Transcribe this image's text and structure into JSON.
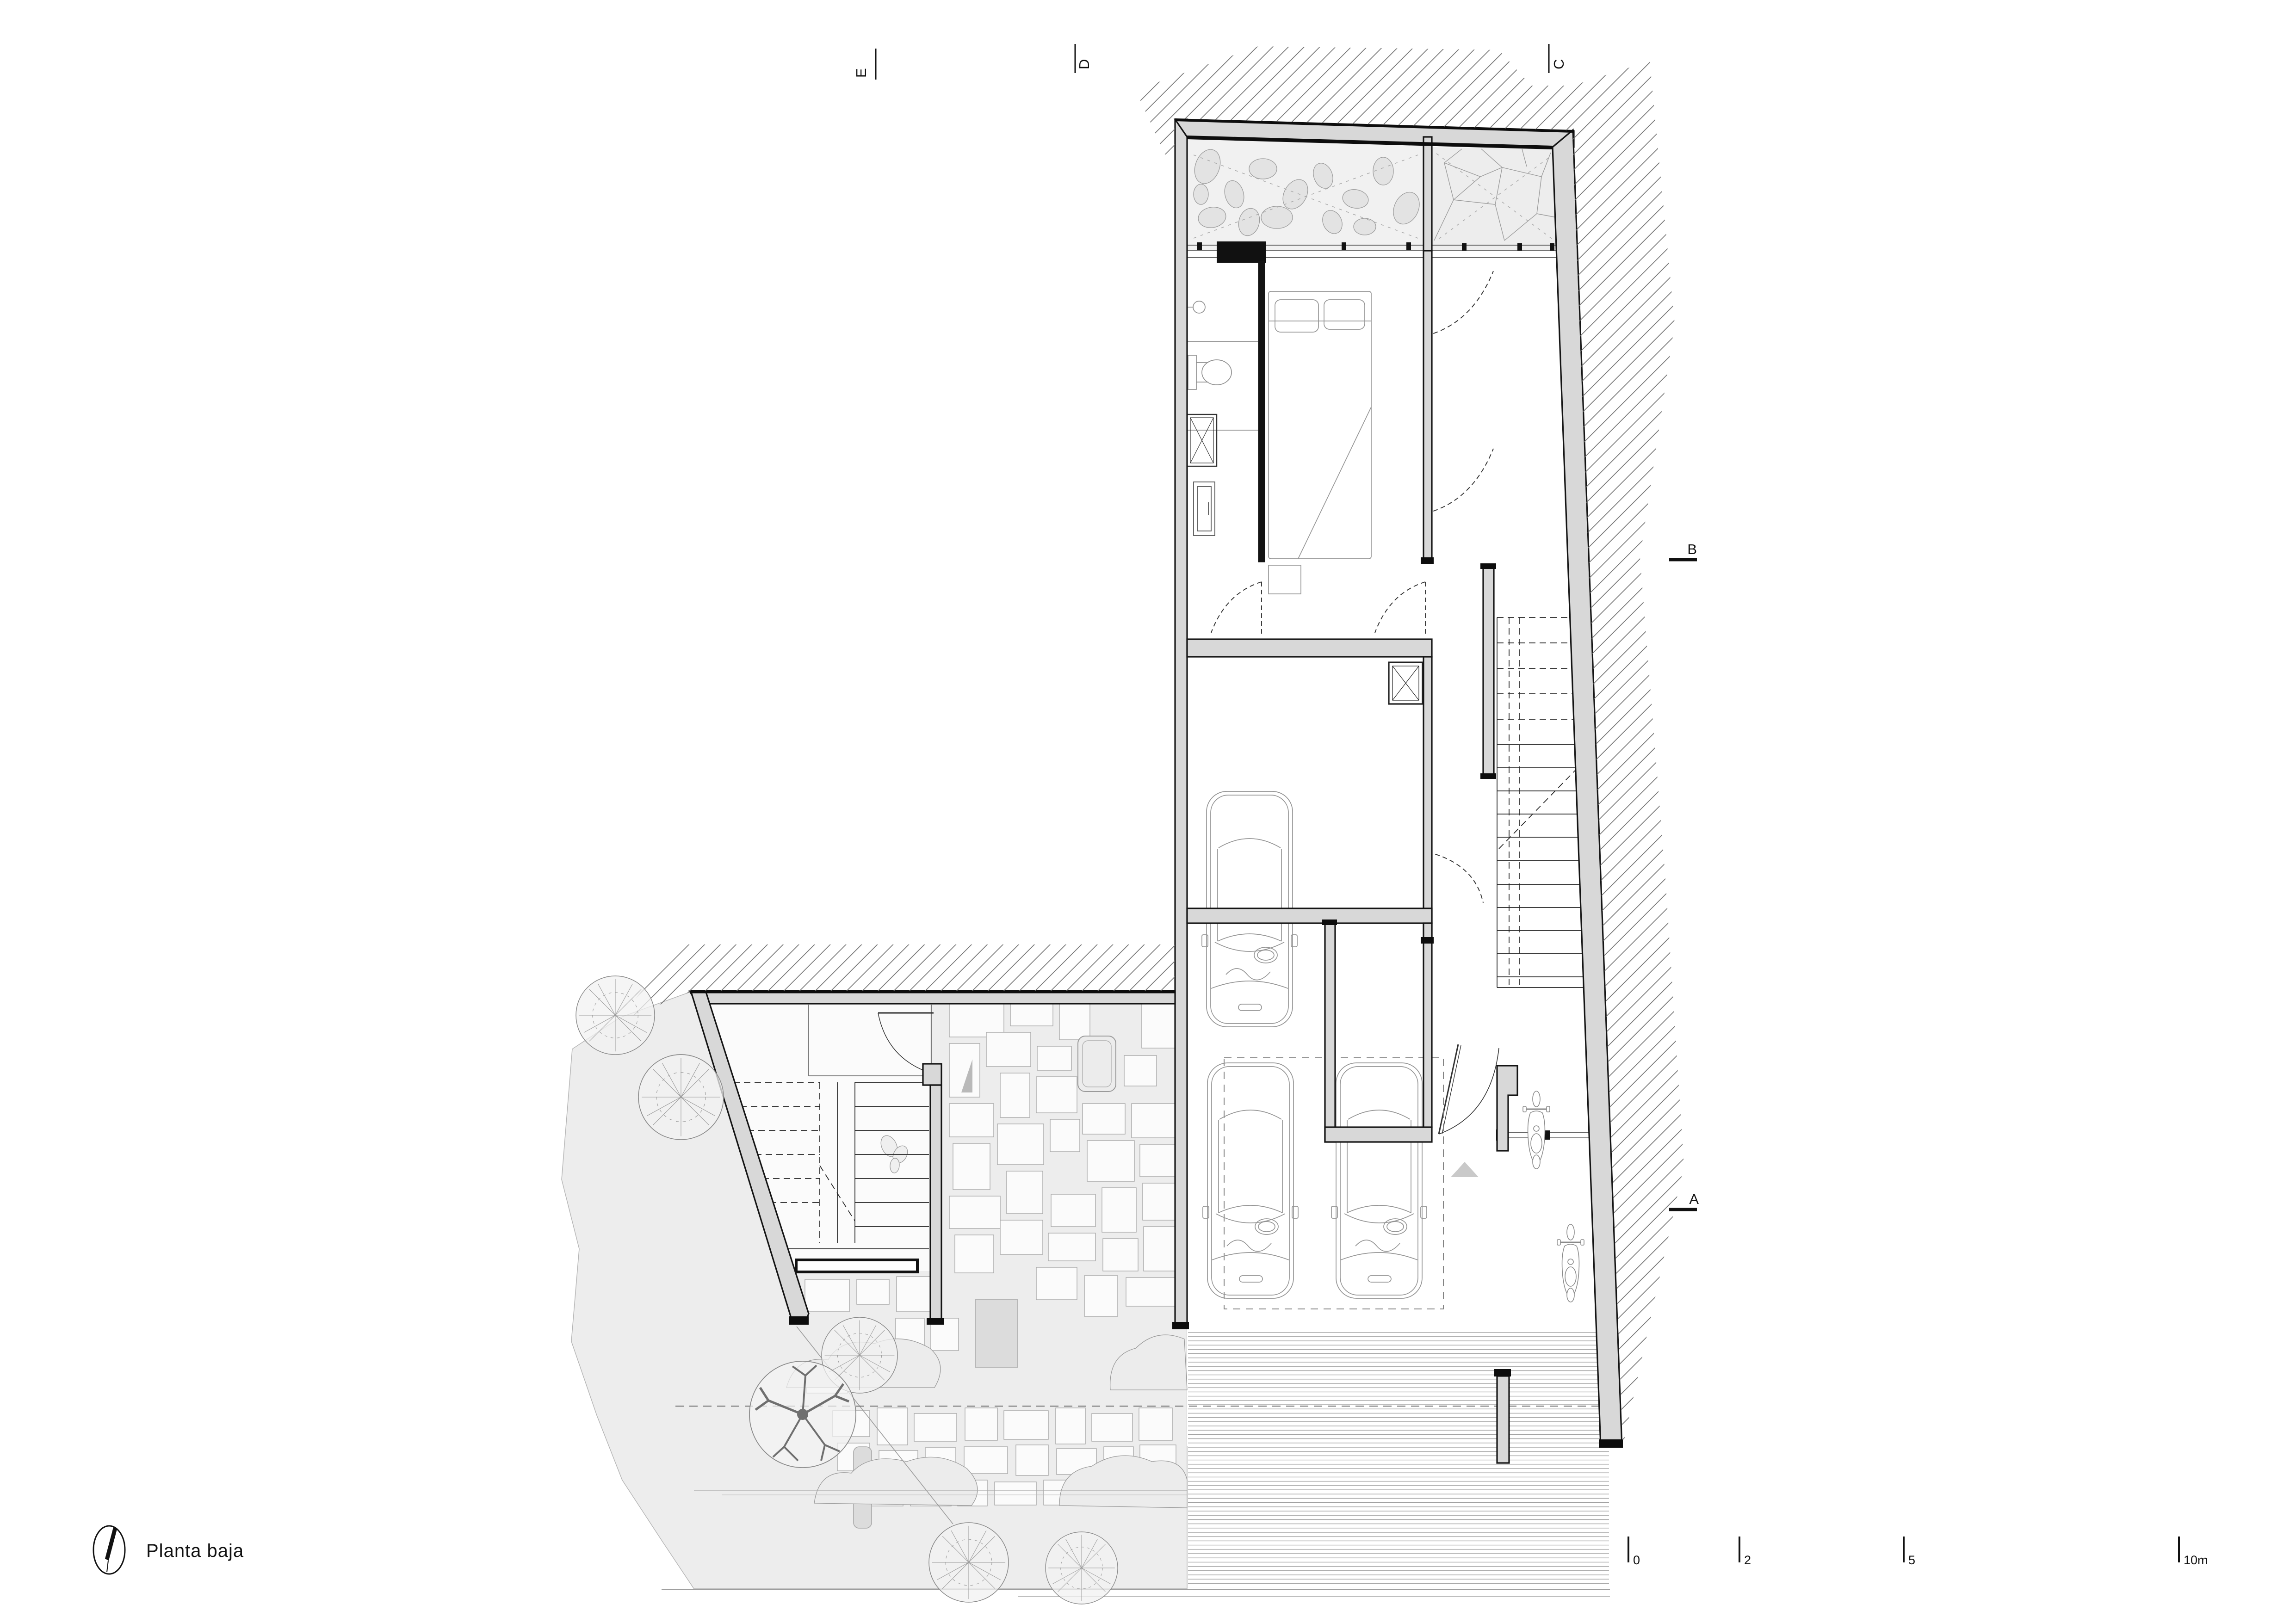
{
  "title": {
    "label": "Planta baja"
  },
  "section_markers": {
    "E": "E",
    "D": "D",
    "C": "C",
    "B": "B",
    "A": "A"
  },
  "scale_bar": {
    "tick_0": "0",
    "tick_2": "2",
    "tick_5": "5",
    "tick_10": "10m"
  },
  "north_indicator": {
    "icon": "north-arrow-icon"
  },
  "colors": {
    "line": "#141414",
    "wall_fill": "#d8d8d8",
    "site_fill": "#ededed",
    "stone_fill": "#fbfbfb",
    "detail_line": "#969696",
    "hatch_line": "#6b6b6b",
    "street_line": "#9a9a9a",
    "entry_arrow_fill": "#c9c9c9"
  }
}
